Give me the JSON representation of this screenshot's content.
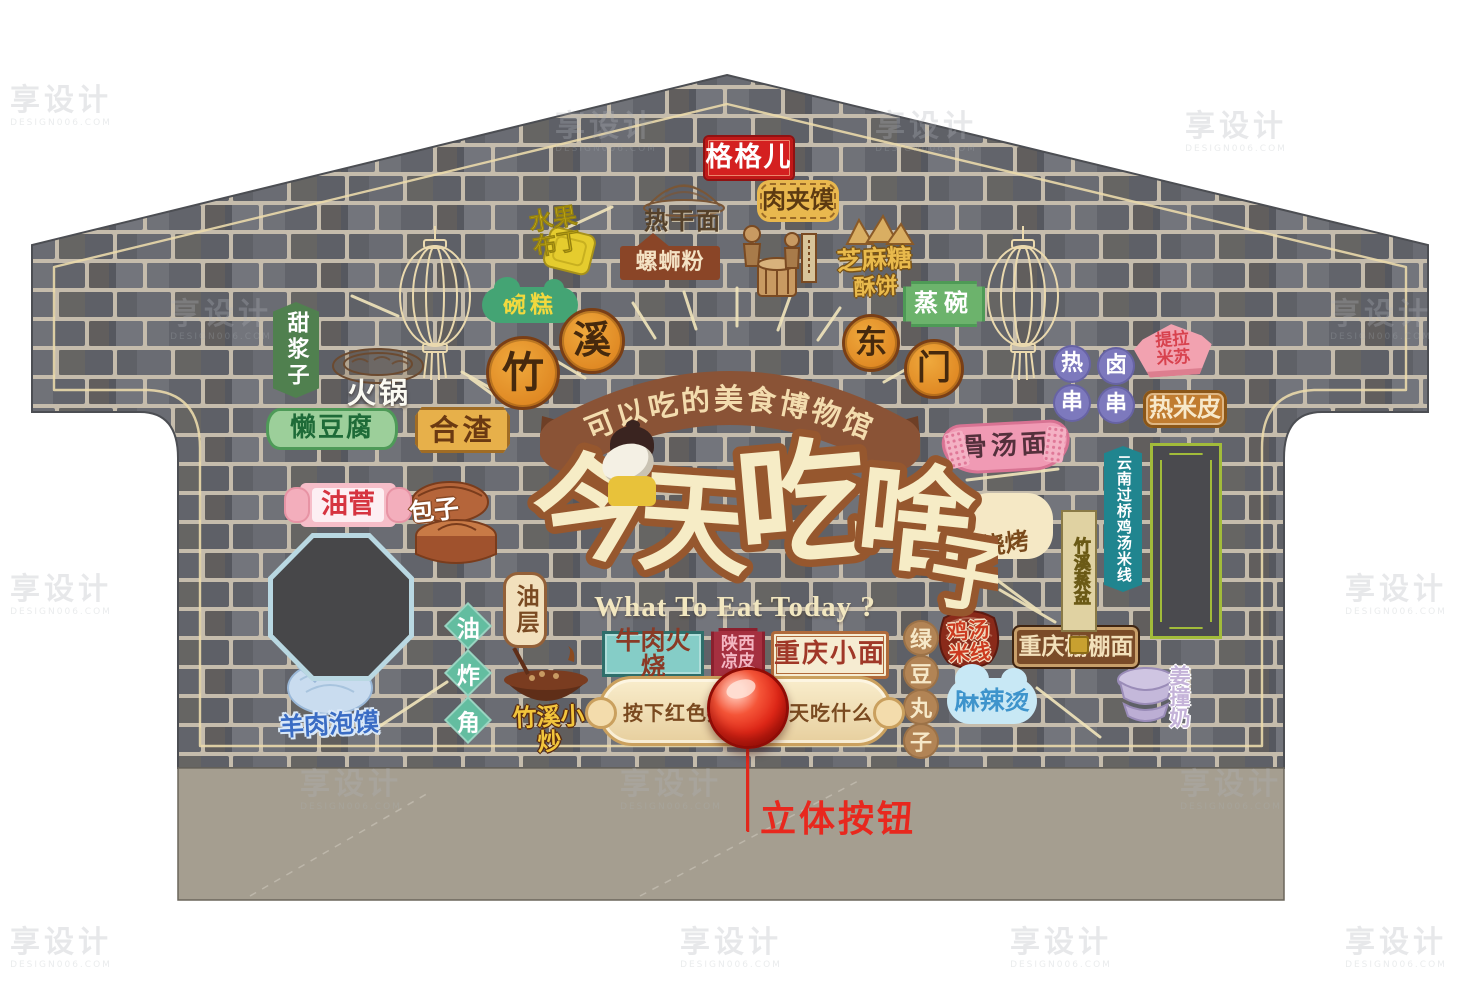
{
  "watermark": {
    "brand": "享设计",
    "sub": "DESIGN006.COM"
  },
  "palette": {
    "brick": "#63656c",
    "mortar": "#c5bcac",
    "plinth": "#a59e90",
    "outline_cream": "#efe3ba",
    "banner_brown": "#8a5336",
    "title_fill": "#f6ecc6",
    "title_halo": "#96572e",
    "button_red": "#e02818",
    "annotation_red": "#e8281e"
  },
  "roof_sign": {
    "label": "格格儿"
  },
  "banner": {
    "title": "可以吃的美食博物馆"
  },
  "title": {
    "zh": "今天吃啥子",
    "en": "What To Eat Today ?"
  },
  "medallions": {
    "left": "竹溪",
    "right": "东门"
  },
  "button": {
    "left": "按下红色按钮",
    "right": "看看今天吃什么",
    "annotation": "立体按钮"
  },
  "labels": {
    "reganmian": "热干面",
    "roujiamo": "肉夹馍",
    "shuiguobuding": [
      "水果",
      "布丁"
    ],
    "luosifen": "螺蛳粉",
    "zhimatangsubing": [
      "芝麻糖",
      "酥饼"
    ],
    "zhengwan": "蒸碗",
    "wangao": "碗糕",
    "tianjiangzi": "甜浆子",
    "huoguo": "火锅",
    "landoufu": "懒豆腐",
    "hezha": "合渣",
    "rechuan": "热串",
    "luchuan": "卤串",
    "tilamisu": [
      "提拉",
      "米苏"
    ],
    "remipi": "热米皮",
    "gutangmian": "骨汤面",
    "yunnanmixian": "云南过桥鸡汤米线",
    "youjian": "油菅",
    "baozi": "包子",
    "youzhajiao": "油炸角",
    "youceng": "油层",
    "yangroupaomo": "羊肉泡馍",
    "zhuxixiaochao": "竹溪小炒",
    "niurouhuoshao": "牛肉火烧",
    "shanxiliangpi": [
      "陕西",
      "凉皮"
    ],
    "chongqingxiaomian": "重庆小面",
    "lvdouwanzi": "绿豆丸子",
    "jitangmixian": [
      "鸡汤",
      "米线"
    ],
    "pengpengmian": "重庆棚棚面",
    "malatang": "麻辣烫",
    "jiangzhuangnai": "姜撞奶",
    "zhuxizhengpen": "竹溪蒸盆",
    "shaokao": "烧烤"
  }
}
